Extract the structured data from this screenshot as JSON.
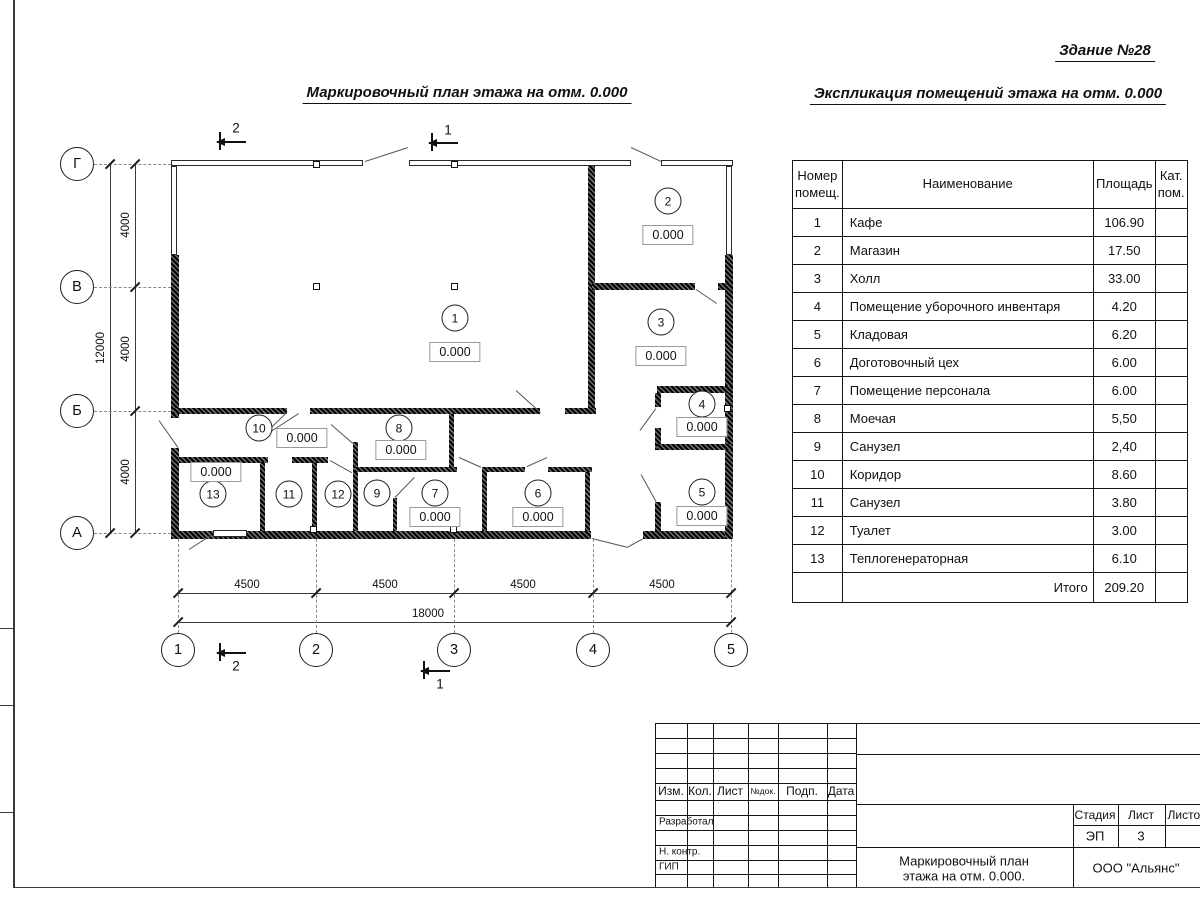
{
  "building_label": "Здание №28",
  "plan_title": "Маркировочный план этажа на отм. 0.000",
  "schedule_title": "Экспликация помещений этажа на отм. 0.000",
  "schedule": {
    "headers": [
      "Номер помещ.",
      "Наименование",
      "Площадь",
      "Кат. пом."
    ],
    "rows": [
      [
        "1",
        "Кафе",
        "106.90",
        ""
      ],
      [
        "2",
        "Магазин",
        "17.50",
        ""
      ],
      [
        "3",
        "Холл",
        "33.00",
        ""
      ],
      [
        "4",
        "Помещение уборочного инвентаря",
        "4.20",
        ""
      ],
      [
        "5",
        "Кладовая",
        "6.20",
        ""
      ],
      [
        "6",
        "Доготовочный цех",
        "6.00",
        ""
      ],
      [
        "7",
        "Помещение персонала",
        "6.00",
        ""
      ],
      [
        "8",
        "Моечая",
        "5,50",
        ""
      ],
      [
        "9",
        "Санузел",
        "2,40",
        ""
      ],
      [
        "10",
        "Коридор",
        "8.60",
        ""
      ],
      [
        "11",
        "Санузел",
        "3.80",
        ""
      ],
      [
        "12",
        "Туалет",
        "3.00",
        ""
      ],
      [
        "13",
        "Теплогенераторная",
        "6.10",
        ""
      ]
    ],
    "total_label": "Итого",
    "total_value": "209.20"
  },
  "plan": {
    "elevation_value": "0.000",
    "row_axes": [
      {
        "label": "Г",
        "y": 164
      },
      {
        "label": "В",
        "y": 287
      },
      {
        "label": "Б",
        "y": 411
      },
      {
        "label": "А",
        "y": 533
      }
    ],
    "col_axes": [
      {
        "label": "1",
        "x": 178
      },
      {
        "label": "2",
        "x": 316
      },
      {
        "label": "3",
        "x": 454
      },
      {
        "label": "4",
        "x": 593
      },
      {
        "label": "5",
        "x": 731
      }
    ],
    "left_dims": [
      {
        "label": "4000",
        "y": 225
      },
      {
        "label": "4000",
        "y": 349
      },
      {
        "label": "4000",
        "y": 472
      }
    ],
    "left_total_dim": "12000",
    "bottom_dims": [
      {
        "label": "4500",
        "x": 247
      },
      {
        "label": "4500",
        "x": 385
      },
      {
        "label": "4500",
        "x": 523
      },
      {
        "label": "4500",
        "x": 662
      }
    ],
    "bottom_total_dim": "18000",
    "rooms": [
      {
        "num": "1",
        "cx": 455,
        "cy": 318,
        "ex": 455,
        "ey": 352
      },
      {
        "num": "2",
        "cx": 668,
        "cy": 201,
        "ex": 668,
        "ey": 235
      },
      {
        "num": "3",
        "cx": 661,
        "cy": 322,
        "ex": 661,
        "ey": 356
      },
      {
        "num": "4",
        "cx": 702,
        "cy": 404,
        "ex": 702,
        "ey": 427
      },
      {
        "num": "5",
        "cx": 702,
        "cy": 492,
        "ex": 702,
        "ey": 516
      },
      {
        "num": "6",
        "cx": 538,
        "cy": 493,
        "ex": 538,
        "ey": 517
      },
      {
        "num": "7",
        "cx": 435,
        "cy": 493,
        "ex": 435,
        "ey": 517
      },
      {
        "num": "8",
        "cx": 399,
        "cy": 428,
        "ex": 401,
        "ey": 450
      },
      {
        "num": "9",
        "cx": 377,
        "cy": 493
      },
      {
        "num": "10",
        "cx": 259,
        "cy": 428,
        "ex": 302,
        "ey": 438
      },
      {
        "num": "11",
        "cx": 289,
        "cy": 494
      },
      {
        "num": "12",
        "cx": 338,
        "cy": 494
      },
      {
        "num": "13",
        "cx": 213,
        "cy": 494,
        "ex": 216,
        "ey": 472
      }
    ],
    "section_marks": [
      {
        "label": "2",
        "lx": 236,
        "ly": 128,
        "ax": 217,
        "ay": 141
      },
      {
        "label": "1",
        "lx": 448,
        "ly": 130,
        "ax": 429,
        "ay": 142
      },
      {
        "label": "2",
        "lx": 236,
        "ly": 666,
        "ax": 217,
        "ay": 652
      },
      {
        "label": "1",
        "lx": 440,
        "ly": 684,
        "ax": 421,
        "ay": 670
      }
    ]
  },
  "title_block": {
    "header_cols": [
      "Изм.",
      "Кол.",
      "Лист",
      "№док.",
      "Подп.",
      "Дата"
    ],
    "row_labels": [
      "Разработал",
      "Н. контр.",
      "ГИП"
    ],
    "stage_headers": [
      "Стадия",
      "Лист",
      "Листов"
    ],
    "stage_value": "ЭП",
    "sheet_value": "3",
    "doc_title_line1": "Маркировочный план",
    "doc_title_line2": "этажа на отм. 0.000.",
    "company": "ООО \"Альянс\""
  }
}
